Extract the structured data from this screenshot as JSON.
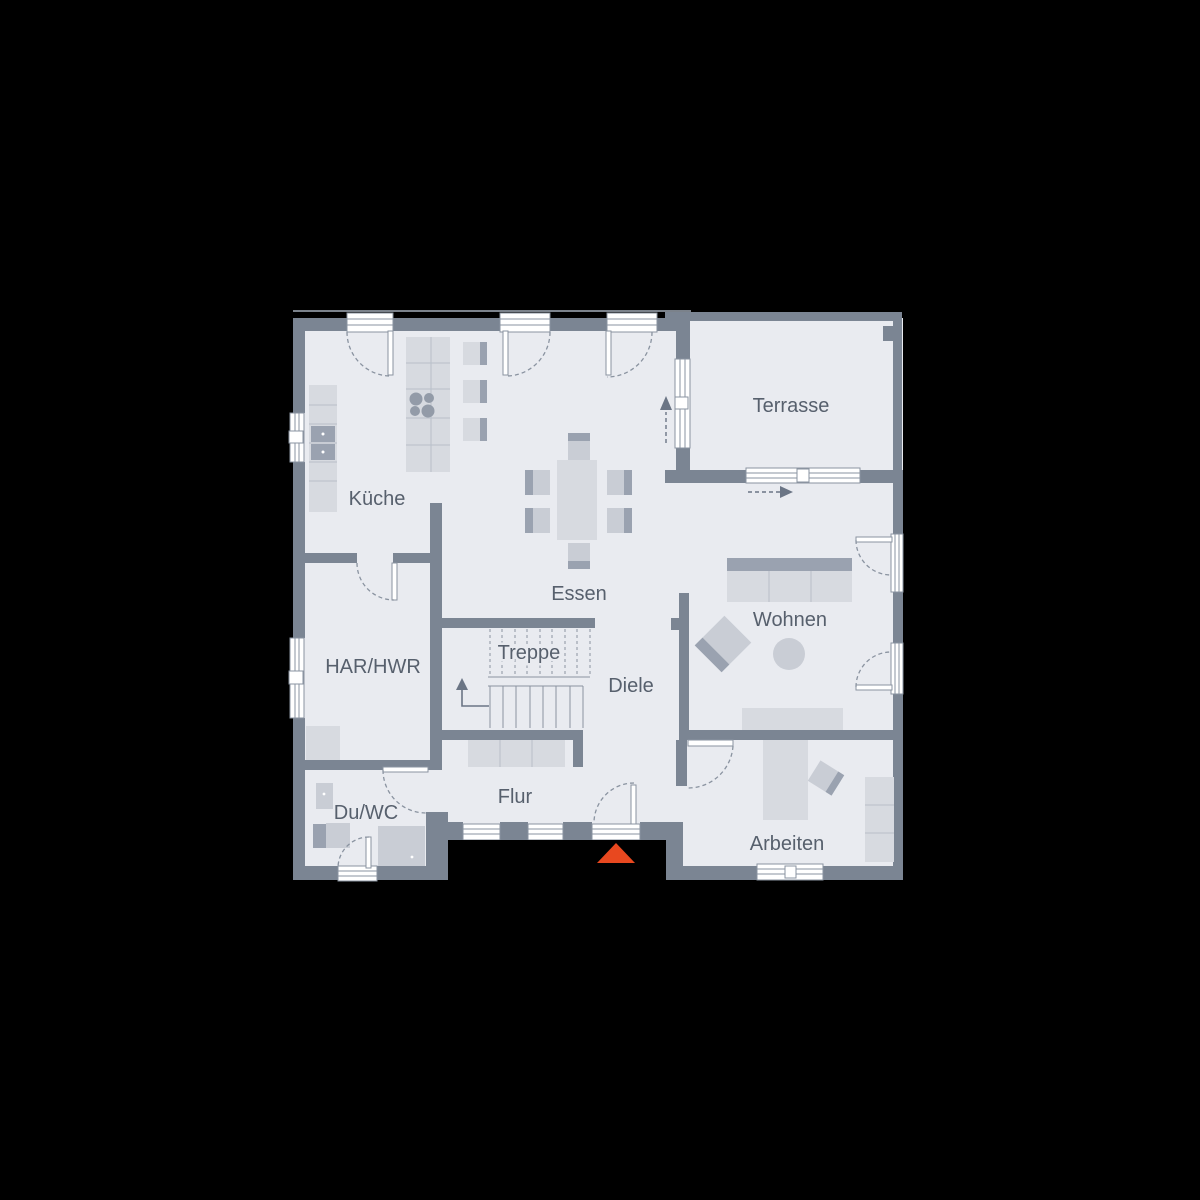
{
  "colors": {
    "bg": "#000000",
    "floor": "#e9ebf0",
    "wall": "#7b8593",
    "furn-light": "#d7dae0",
    "furn-mid": "#c9cdd5",
    "furn-dark": "#9aa2b0",
    "grid": "#b9bfc9",
    "frame": "#8a93a0",
    "label": "#57606d",
    "arrow": "#6b7585",
    "accent": "#e8481f",
    "white": "#ffffff"
  },
  "plan": {
    "type": "floor-plan",
    "rooms": {
      "kueche": {
        "label": "Küche"
      },
      "essen": {
        "label": "Essen"
      },
      "terrasse": {
        "label": "Terrasse"
      },
      "wohnen": {
        "label": "Wohnen"
      },
      "har_hwr": {
        "label": "HAR/HWR"
      },
      "treppe": {
        "label": "Treppe"
      },
      "diele": {
        "label": "Diele"
      },
      "du_wc": {
        "label": "Du/WC"
      },
      "flur": {
        "label": "Flur"
      },
      "arbeiten": {
        "label": "Arbeiten"
      }
    },
    "symbols": {
      "entrance_marker_color": "#e8481f",
      "stair_direction": "up",
      "terrace_exit_arrows": 2
    }
  }
}
